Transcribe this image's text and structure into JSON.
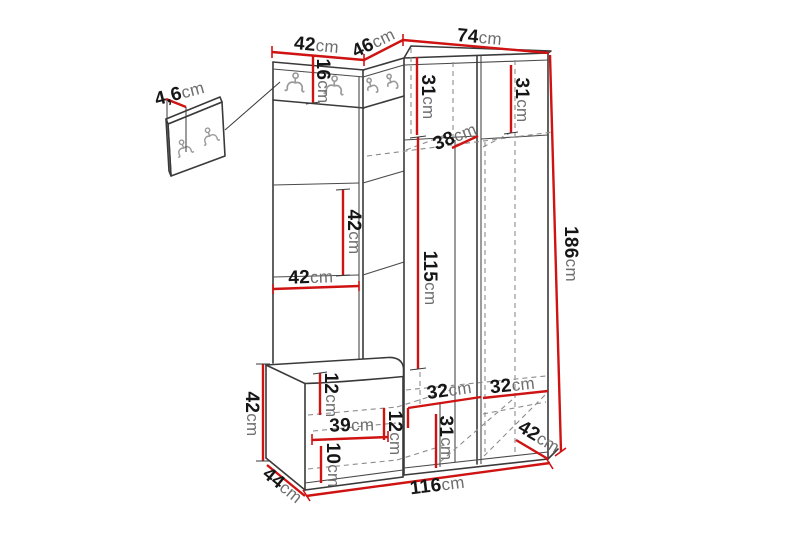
{
  "diagram": {
    "kind": "hallway-furniture-dimension-drawing",
    "colors": {
      "dimension_line": "#ce1312",
      "outline": "#3a3a3a",
      "hidden_edge": "#8c8c8c",
      "hook": "#9a9a9a",
      "number_text": "#161616",
      "unit_text": "#6e6e6e",
      "background": "#ffffff"
    }
  },
  "dimensions": [
    {
      "name": "panel-thickness",
      "value": "4,6",
      "unit": "cm"
    },
    {
      "name": "left-wing-width",
      "value": "42",
      "unit": "cm"
    },
    {
      "name": "corner-section-width",
      "value": "46",
      "unit": "cm"
    },
    {
      "name": "wardrobe-width",
      "value": "74",
      "unit": "cm"
    },
    {
      "name": "hook-band-height",
      "value": "16",
      "unit": "cm"
    },
    {
      "name": "upper-left-compartment-height",
      "value": "31",
      "unit": "cm"
    },
    {
      "name": "upper-right-compartment-height",
      "value": "31",
      "unit": "cm"
    },
    {
      "name": "shelf-depth",
      "value": "38",
      "unit": "cm"
    },
    {
      "name": "wing-section-height",
      "value": "42",
      "unit": "cm"
    },
    {
      "name": "wing-inner-width",
      "value": "42",
      "unit": "cm"
    },
    {
      "name": "hanging-space-height",
      "value": "115",
      "unit": "cm"
    },
    {
      "name": "total-height",
      "value": "186",
      "unit": "cm"
    },
    {
      "name": "bench-height",
      "value": "42",
      "unit": "cm"
    },
    {
      "name": "bench-top-thickness",
      "value": "12",
      "unit": "cm"
    },
    {
      "name": "bench-shelf-width",
      "value": "39",
      "unit": "cm"
    },
    {
      "name": "bench-upper-compartment-height",
      "value": "12",
      "unit": "cm"
    },
    {
      "name": "bench-lower-compartment-height",
      "value": "10",
      "unit": "cm"
    },
    {
      "name": "lower-left-compartment-width",
      "value": "32",
      "unit": "cm"
    },
    {
      "name": "lower-right-compartment-width",
      "value": "32",
      "unit": "cm"
    },
    {
      "name": "lower-compartment-height",
      "value": "31",
      "unit": "cm"
    },
    {
      "name": "wardrobe-depth",
      "value": "42",
      "unit": "cm"
    },
    {
      "name": "bench-depth",
      "value": "44",
      "unit": "cm"
    },
    {
      "name": "total-width",
      "value": "116",
      "unit": "cm"
    }
  ]
}
